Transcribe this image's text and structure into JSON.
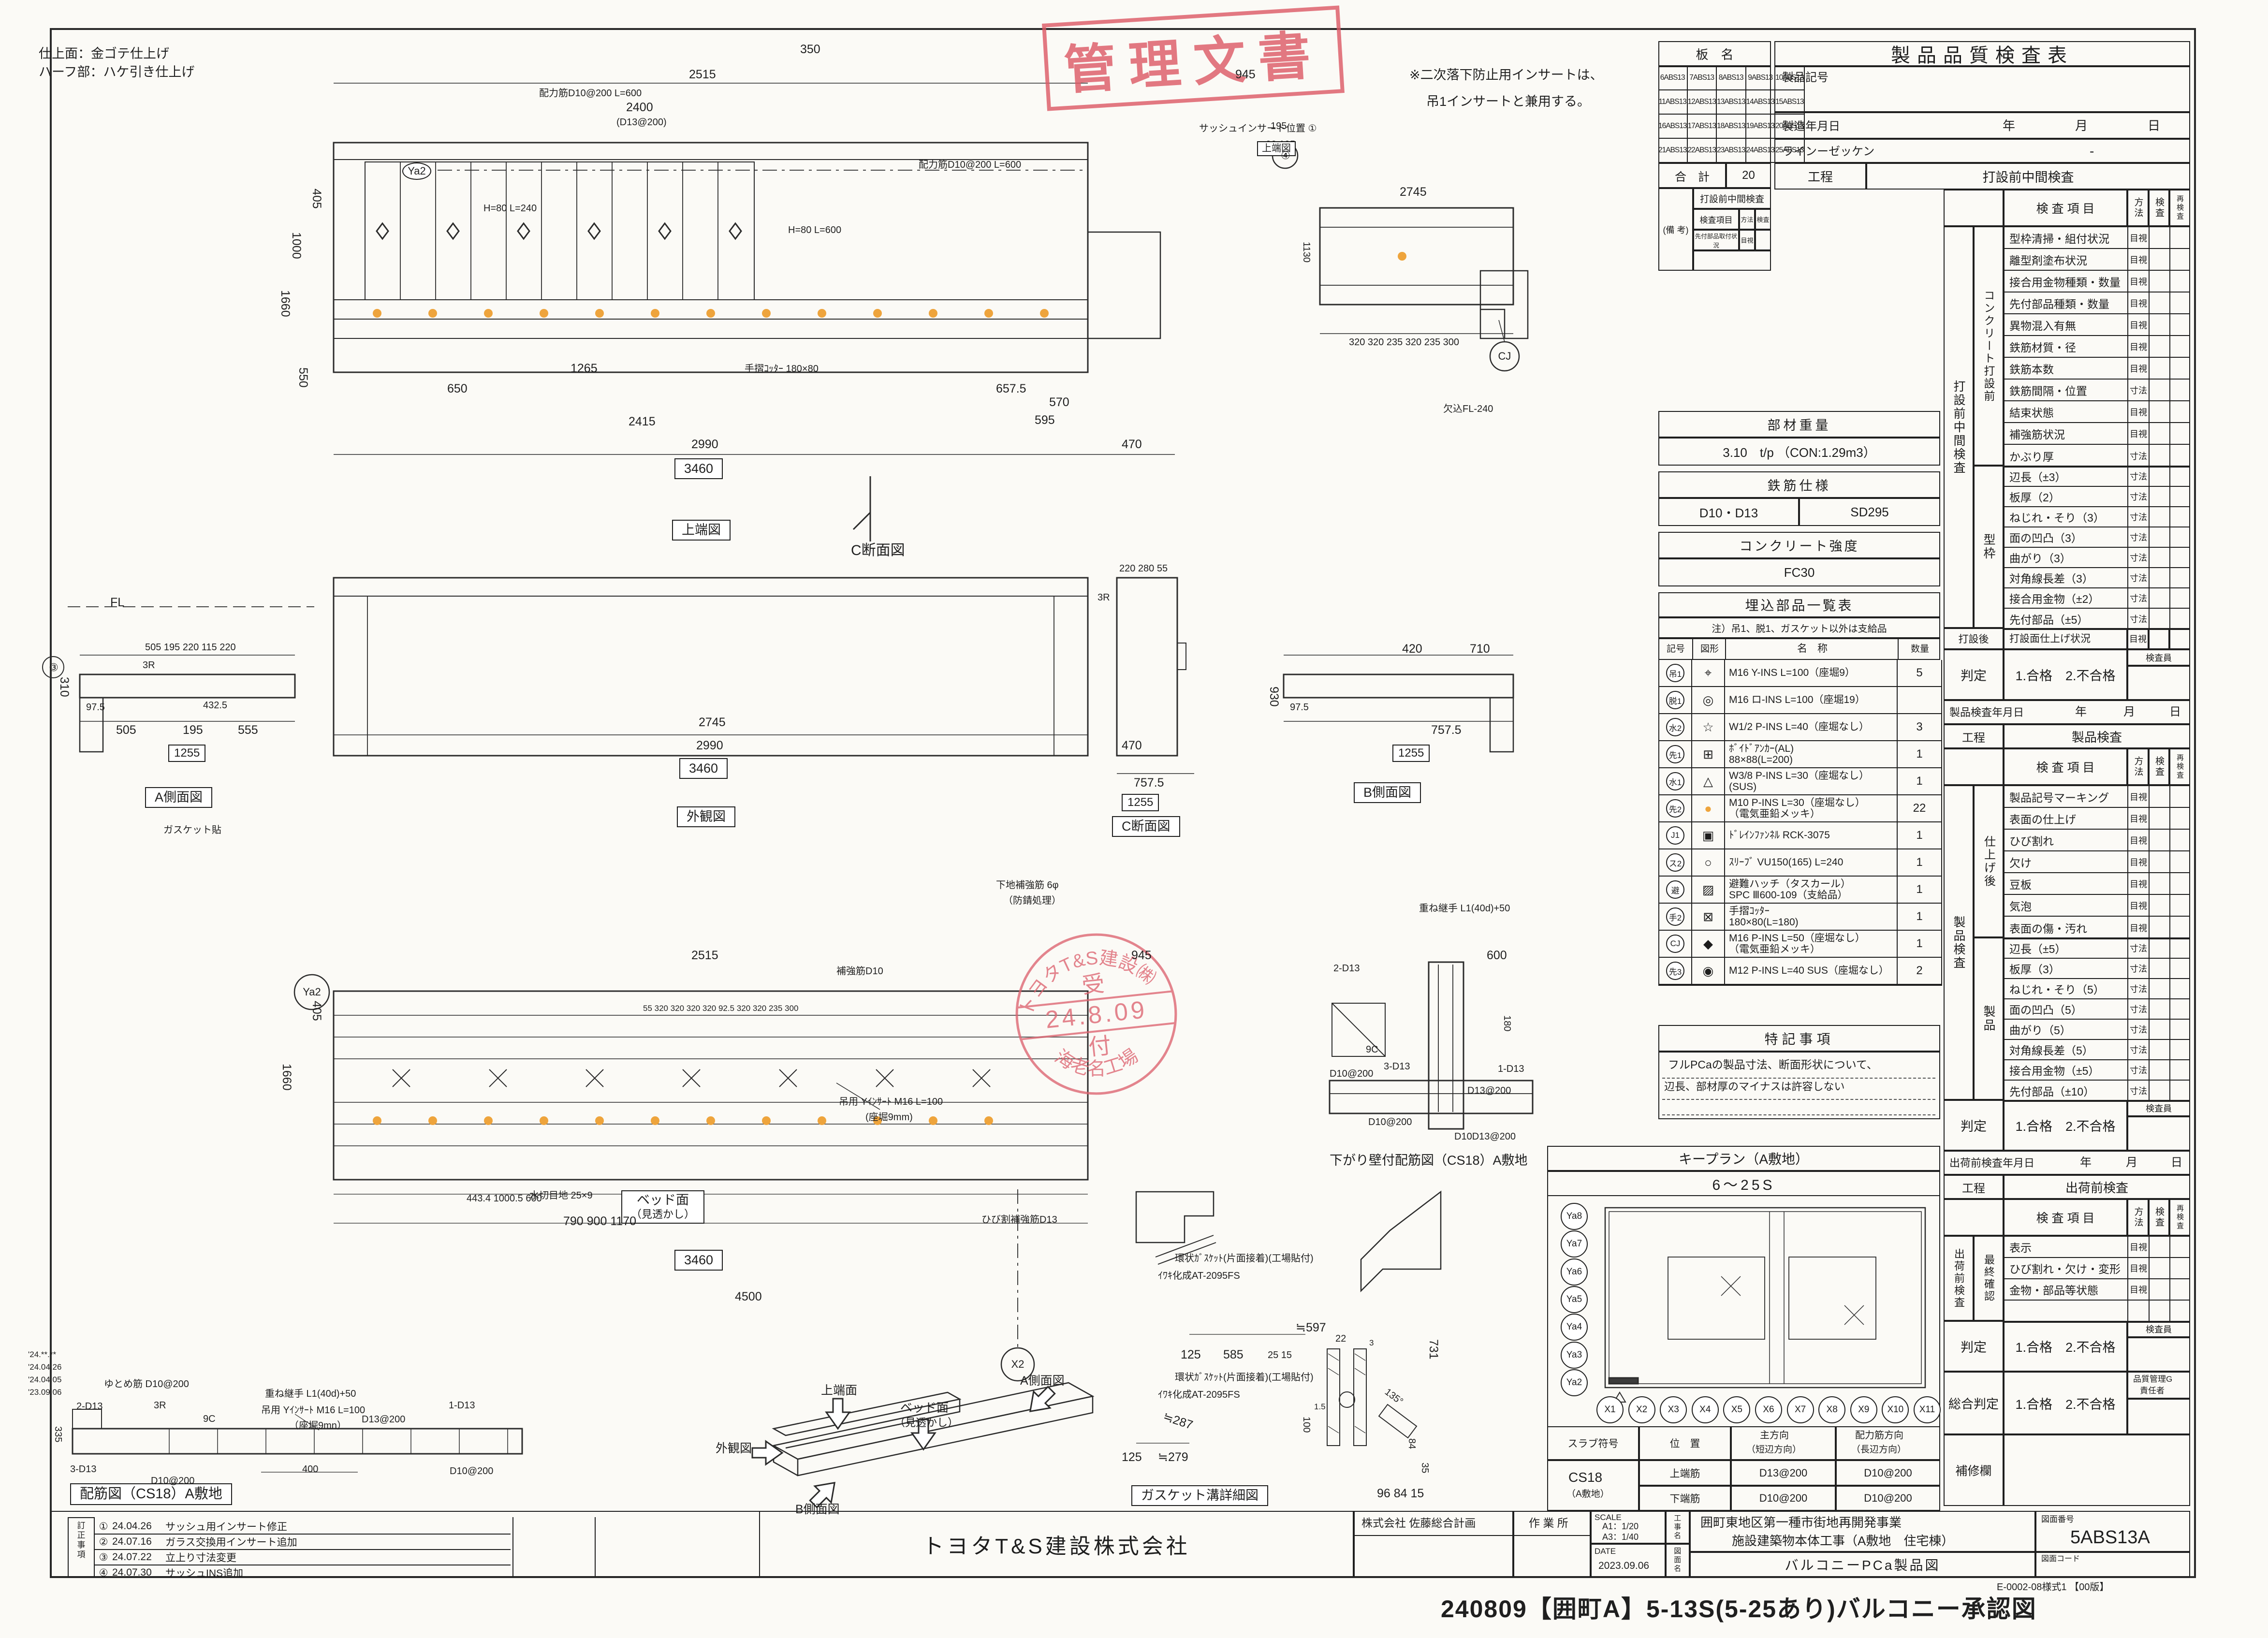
{
  "sheet": {
    "footer_note": "E-0002-08様式1 【00版】",
    "footer_title": "240809【囲町A】5-13S(5-25あり)バルコニー承認図"
  },
  "notes": {
    "finish1": "仕上面：金ゴテ仕上げ",
    "finish2": "ハーフ部：ハケ引き仕上げ",
    "insert1": "※二次落下防止用インサートは、",
    "insert2": "吊1インサートと兼用する。",
    "dates": [
      "'24.**.**",
      "'24.04.26",
      "'24.04.05",
      "'23.09.06"
    ]
  },
  "stamps": {
    "kanri": "管理文書",
    "company": "トヨタT&S建設㈱",
    "uke1": "受",
    "date": "24.8.09",
    "uke2": "付",
    "factory": "海老名工場"
  },
  "ban_mei": {
    "title": "板　名",
    "cells": [
      "6ABS13",
      "7ABS13",
      "8ABS13",
      "9ABS13",
      "10ABS13",
      "11ABS13",
      "12ABS13",
      "13ABS13",
      "14ABS13",
      "15ABS13",
      "16ABS13",
      "17ABS13",
      "18ABS13",
      "19ABS13",
      "20ABS13",
      "21ABS13",
      "22ABS13",
      "23ABS13",
      "24ABS13",
      "25ABS13"
    ],
    "total_label": "合　計",
    "total": "20",
    "remark": "(備 考)",
    "r1": "打設前中間検査",
    "r2a": "検査項目",
    "r2b": "方法",
    "r2c": "検査",
    "r3a": "先付部品取付状況",
    "r3b": "目視"
  },
  "qc": {
    "title": "製品品質検査表",
    "f1": "製品記号",
    "f2": "製造年月日",
    "f3": "ラインーゼッケン",
    "f3v": "-",
    "ymd1": "年",
    "ymd2": "月",
    "ymd3": "日",
    "koutei": "工程",
    "item_h": "検 査 項 目",
    "m_h": "方法",
    "c_h": "検査",
    "r_h": "再検査",
    "inspector": "検査員",
    "s1": {
      "stage": "打設前中間検査",
      "vlabel": "打設前中間検査",
      "g1": {
        "label": "コンクリート打設前",
        "rows": [
          {
            "t": "型枠清掃・組付状況",
            "m": "目視"
          },
          {
            "t": "離型剤塗布状況",
            "m": "目視"
          },
          {
            "t": "接合用金物種類・数量",
            "m": "目視"
          },
          {
            "t": "先付部品種類・数量",
            "m": "目視"
          },
          {
            "t": "異物混入有無",
            "m": "目視"
          },
          {
            "t": "鉄筋材質・径",
            "m": "目視"
          },
          {
            "t": "鉄筋本数",
            "m": "目視"
          },
          {
            "t": "鉄筋間隔・位置",
            "m": "寸法"
          },
          {
            "t": "結束状態",
            "m": "目視"
          },
          {
            "t": "補強筋状況",
            "m": "目視"
          },
          {
            "t": "かぶり厚",
            "m": "寸法"
          }
        ]
      },
      "g2": {
        "label": "型枠",
        "rows": [
          {
            "t": "辺長（±3）",
            "m": "寸法"
          },
          {
            "t": "板厚（2）",
            "m": "寸法"
          },
          {
            "t": "ねじれ・そり（3）",
            "m": "寸法"
          },
          {
            "t": "面の凹凸（3）",
            "m": "寸法"
          },
          {
            "t": "曲がり（3）",
            "m": "寸法"
          },
          {
            "t": "対角線長差（3）",
            "m": "寸法"
          },
          {
            "t": "接合用金物（±2）",
            "m": "寸法"
          },
          {
            "t": "先付部品（±5）",
            "m": "寸法"
          }
        ]
      },
      "post_label": "打設後",
      "post_item": "打設面仕上げ状況",
      "post_m": "目視",
      "judge_label": "判定",
      "judge_value": "1.合格　2.不合格"
    },
    "s2": {
      "date_label": "製品検査年月日",
      "stage": "製品検査",
      "vlabel": "製品検査",
      "g1": {
        "label": "仕上げ後",
        "rows": [
          {
            "t": "製品記号マーキング",
            "m": "目視"
          },
          {
            "t": "表面の仕上げ",
            "m": "目視"
          },
          {
            "t": "ひび割れ",
            "m": "目視"
          },
          {
            "t": "欠け",
            "m": "目視"
          },
          {
            "t": "豆板",
            "m": "目視"
          },
          {
            "t": "気泡",
            "m": "目視"
          },
          {
            "t": "表面の傷・汚れ",
            "m": "目視"
          }
        ]
      },
      "g2": {
        "label": "製品",
        "rows": [
          {
            "t": "辺長（±5）",
            "m": "寸法"
          },
          {
            "t": "板厚（3）",
            "m": "寸法"
          },
          {
            "t": "ねじれ・そり（5）",
            "m": "寸法"
          },
          {
            "t": "面の凹凸（5）",
            "m": "寸法"
          },
          {
            "t": "曲がり（5）",
            "m": "寸法"
          },
          {
            "t": "対角線長差（5）",
            "m": "寸法"
          },
          {
            "t": "接合用金物（±5）",
            "m": "寸法"
          },
          {
            "t": "先付部品（±10）",
            "m": "寸法"
          }
        ]
      },
      "judge_label": "判定",
      "judge_value": "1.合格　2.不合格"
    },
    "s3": {
      "date_label": "出荷前検査年月日",
      "stage": "出荷前検査",
      "vlabel": "出荷前検査",
      "g1": {
        "label": "最終確認",
        "rows": [
          {
            "t": "表示",
            "m": "目視"
          },
          {
            "t": "ひび割れ・欠け・変形",
            "m": "目視"
          },
          {
            "t": "金物・部品等状態",
            "m": "目視"
          },
          {
            "t": "",
            "m": ""
          }
        ]
      },
      "judge_label": "判定",
      "judge_value": "1.合格　2.不合格"
    },
    "overall_label": "総合判定",
    "overall_value": "1.合格　2.不合格",
    "approver1": "品質管理G",
    "approver2": "責任者",
    "repair": "補修欄"
  },
  "material": {
    "w_title": "部材重量",
    "w_value": "3.10　t/p （CON:1.29m3）",
    "r_title": "鉄筋仕様",
    "r_v1": "D10・D13",
    "r_v2": "SD295",
    "c_title": "コンクリート強度",
    "c_value": "FC30"
  },
  "parts": {
    "title": "埋込部品一覧表",
    "note": "注）吊1、脱1、ガスケット以外は支給品",
    "h_code": "記号",
    "h_sym": "図形",
    "h_name": "名　称",
    "h_qty": "数量",
    "rows": [
      {
        "code": "吊1",
        "sym": "⌖",
        "name": "M16 Y-INS L=100（座堀9）",
        "name2": "",
        "qty": "5"
      },
      {
        "code": "脱1",
        "sym": "◎",
        "name": "M16 ロ-INS L=100（座堀19）",
        "name2": "",
        "qty": ""
      },
      {
        "code": "水2",
        "sym": "☆",
        "name": "W1/2 P-INS L=40（座堀なし）",
        "name2": "",
        "qty": "3"
      },
      {
        "code": "先1",
        "sym": "⊞",
        "name": "ﾎﾞｲﾄﾞｱﾝｶｰ(AL)",
        "name2": "88×88(L=200)",
        "qty": "1"
      },
      {
        "code": "水1",
        "sym": "△",
        "name": "W3/8 P-INS L=30（座堀なし）",
        "name2": "(SUS)",
        "qty": "1"
      },
      {
        "code": "先2",
        "sym": "●",
        "name": "M10 P-INS L=30（座堀なし）",
        "name2": "（電気亜鉛メッキ）",
        "qty": "22"
      },
      {
        "code": "J1",
        "sym": "▣",
        "name": "ﾄﾞﾚｲﾝﾌｧﾝﾈﾙ RCK-3075",
        "name2": "",
        "qty": "1"
      },
      {
        "code": "ス2",
        "sym": "○",
        "name": "ｽﾘｰﾌﾞ VU150(165) L=240",
        "name2": "",
        "qty": "1"
      },
      {
        "code": "避",
        "sym": "▨",
        "name": "避難ハッチ（タスカール）",
        "name2": "SPC Ⅲ600-109（支給品）",
        "qty": "1"
      },
      {
        "code": "手2",
        "sym": "⊠",
        "name": "手摺ｺｯﾀｰ",
        "name2": "180×80(L=180)",
        "qty": "1"
      },
      {
        "code": "CJ",
        "sym": "◆",
        "name": "M16 P-INS L=50（座堀なし）",
        "name2": "（電気亜鉛メッキ）",
        "qty": "1"
      },
      {
        "code": "先3",
        "sym": "◉",
        "name": "M12 P-INS L=40 SUS（座堀なし）",
        "name2": "",
        "qty": "2"
      }
    ]
  },
  "tokki": {
    "title": "特記事項",
    "line1": "フルPCaの製品寸法、断面形状について、",
    "line2": "辺長、部材厚のマイナスは許容しない"
  },
  "keyplan": {
    "title": "キープラン（A敷地）",
    "range": "6～25S",
    "ya": [
      "Ya8",
      "Ya7",
      "Ya6",
      "Ya5",
      "Ya4",
      "Ya3",
      "Ya2"
    ],
    "x": [
      "X1",
      "X2",
      "X3",
      "X4",
      "X5",
      "X6",
      "X7",
      "X8",
      "X9",
      "X10",
      "X11"
    ]
  },
  "slab": {
    "h1": "スラブ符号",
    "h2": "位　置",
    "h3a": "主方向",
    "h3b": "（短辺方向）",
    "h4a": "配力筋方向",
    "h4b": "（長辺方向）",
    "code1": "CS18",
    "code2": "（A敷地）",
    "r1": "上端筋",
    "r1m": "D13@200",
    "r1s": "D10@200",
    "r2": "下端筋",
    "r2m": "D10@200",
    "r2s": "D10@200"
  },
  "titleblock": {
    "contractor": "トヨタT&S建設株式会社",
    "architect": "株式会社 佐藤総合計画",
    "site": "作 業 所",
    "scale_label": "SCALE",
    "scale1": "A1：1/20",
    "scale2": "A3：1/40",
    "date_label": "DATE",
    "date": "2023.09.06",
    "kouji_label": "工事名",
    "zumen_label": "図面名",
    "project1": "囲町東地区第一種市街地再開発事業",
    "project2": "施設建築物本体工事（A敷地　住宅棟）",
    "dwg_name": "バルコニーPCa製品図",
    "dwg_no_label": "図面番号",
    "dwg_no": "5ABS13A",
    "dwg_code_label": "図面コード"
  },
  "revisions": {
    "vlabel": "訂正事項",
    "rows": [
      {
        "no": "①",
        "date": "24.04.26",
        "desc": "サッシュ用インサート修正"
      },
      {
        "no": "②",
        "date": "24.07.16",
        "desc": "ガラス交換用インサート追加"
      },
      {
        "no": "③",
        "date": "24.07.22",
        "desc": "立上り寸法変更"
      },
      {
        "no": "④",
        "date": "24.07.30",
        "desc": "サッシュINS追加"
      }
    ]
  },
  "views": {
    "plan": {
      "t": [
        "350",
        "2515",
        "945",
        "2400",
        "(D13@200)",
        "配力筋D10@200 L=600",
        "配力筋D10@200 L=600",
        "1000",
        "405",
        "1660",
        "550",
        "2990",
        "3460",
        "2415",
        "650",
        "1265",
        "470",
        "570",
        "595",
        "657.5",
        "手摺ｺｯﾀｰ 180×80",
        "H=80 L=240",
        "H=80 L=600",
        "欠込FL-240",
        "195",
        "90 105",
        "サッシュインサート位置 ①",
        "上端図",
        "C断面図",
        "上端図",
        "④",
        "2745",
        "320 320 235 320 235 300",
        "1130",
        "CJ",
        "Ya2"
      ]
    },
    "aside": {
      "t": [
        "A側面図",
        "ガスケット貼",
        "FL",
        "505  195  220 115 220",
        "505",
        "195",
        "555",
        "1255",
        "310",
        "432.5",
        "97.5",
        "3R",
        "③"
      ]
    },
    "gaikan": {
      "t": [
        "外観図",
        "2745",
        "2990",
        "3460",
        "470"
      ]
    },
    "csec": {
      "t": [
        "C断面図",
        "220  280  55",
        "3R",
        "757.5",
        "1255"
      ]
    },
    "bside": {
      "t": [
        "B側面図",
        "420",
        "710",
        "757.5",
        "1255",
        "930",
        "97.5"
      ]
    },
    "rebar": {
      "t": [
        "ベッド面",
        "（見透かし）",
        "2515",
        "945",
        "405",
        "1660",
        "水切目地 25×9",
        "ひび割補強筋D13",
        "補強筋D10",
        "吊用 Yｲﾝｻｰﾄ M16 L=100",
        "(座堀9mm)",
        "55 320 320 320 320 92.5 320 320 235 300",
        "443.4   1000.5   600",
        "790   900   1170",
        "3460",
        "4500",
        "X2",
        "Ya2",
        "重ね継手 L1(40d)+50"
      ]
    },
    "sagari": {
      "t": [
        "下がり壁付配筋図（CS18）A敷地",
        "600",
        "2-D13",
        "9C",
        "3-D13",
        "1-D13",
        "D13@200",
        "D10@200",
        "D10D13@200",
        "180",
        "D10@200"
      ]
    },
    "gasket": {
      "t": [
        "ガスケット溝詳細図",
        "≒597",
        "585",
        "125",
        "25 15",
        "731",
        "135°",
        "84",
        "96  84  15",
        "≒287",
        "≒279",
        "125",
        "100",
        "22",
        "1.5",
        "3",
        "35"
      ]
    },
    "iso": {
      "t": [
        "外観図",
        "上端面",
        "ベッド面",
        "（見透かし）",
        "A側面図",
        "B側面図"
      ]
    },
    "bed": {
      "t": [
        "配筋図（CS18）A敷地",
        "ゆとめ筋 D10@200",
        "2-D13",
        "3R",
        "9C",
        "重ね継手 L1(40d)+50",
        "吊用 Yｲﾝｻｰﾄ M16 L=100",
        "（座堀9mn）",
        "D13@200",
        "1-D13",
        "3-D13",
        "D10@200",
        "400",
        "D10@200",
        "335"
      ]
    },
    "gasket_notes": {
      "t": [
        "環状ｶﾞｽｹｯﾄ(片面接着)(工場貼付)",
        "ｲﾜｷ化成AT-2095FS",
        "環状ｶﾞｽｹｯﾄ(片面接着)(工場貼付)",
        "ｲﾜｷ化成AT-2095FS",
        "下地補強筋 6φ",
        "（防錆処理）"
      ]
    }
  }
}
